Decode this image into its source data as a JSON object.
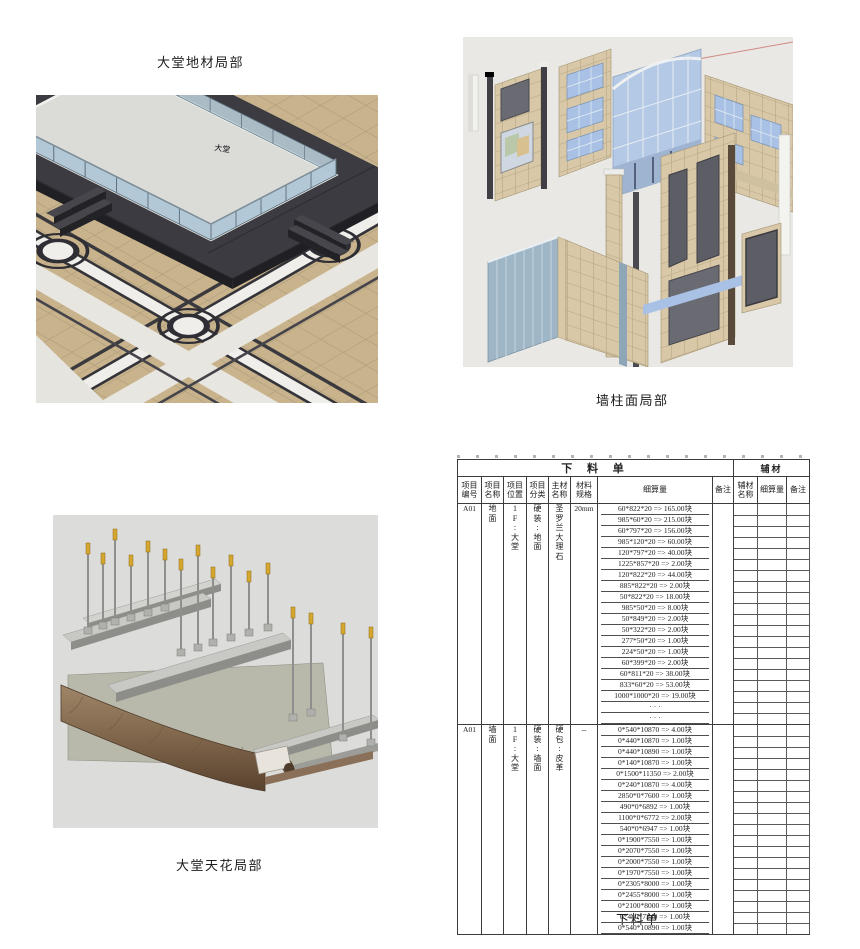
{
  "captions": {
    "floor": "大堂地材局部",
    "wall": "墙柱面局部",
    "ceiling": "大堂天花局部",
    "table": "下料单"
  },
  "figures": {
    "floor": {
      "marker": "大堂"
    }
  },
  "palette": {
    "floor_tan": "#c9b38c",
    "wall_tile_tan": "#d8c8a8",
    "glass_blue": "#b0c7d6",
    "window_blue": "#a8c1e4",
    "dark_tile": "#3b3b41",
    "panel_gray": "#5d5d65",
    "wood_brown": "#8a7058",
    "rod_tip_yellow": "#d6a72e",
    "table_line": "#3c3c3c"
  },
  "table": {
    "title": "下 料 单",
    "aux_header": "辅材",
    "columns": [
      "项目\n编号",
      "项目\n名称",
      "项目\n位置",
      "项目\n分类",
      "主材\n名称",
      "材料\n规格",
      "细算量",
      "备注",
      "辅材\n名称",
      "细算量",
      "备注"
    ],
    "sections": [
      {
        "code": "A01",
        "name": "地面",
        "location": "1F:大堂",
        "category": "硬装:地面",
        "material": "圣罗兰大理石",
        "spec": "20mm",
        "rows": [
          "60*822*20 => 165.00块",
          "985*60*20 => 215.00块",
          "60*797*20 => 156.00块",
          "985*120*20 => 60.00块",
          "120*797*20 => 40.00块",
          "1225*857*20 => 2.00块",
          "120*822*20 => 44.00块",
          "885*822*20 => 2.00块",
          "50*822*20 => 18.00块",
          "985*50*20 => 8.00块",
          "50*849*20 => 2.00块",
          "50*322*20 => 2.00块",
          "277*50*20 => 1.00块",
          "224*50*20 => 1.00块",
          "60*399*20 => 2.00块",
          "60*811*20 => 38.00块",
          "833*60*20 => 53.00块",
          "1000*1000*20 => 19.00块",
          "· · ·",
          "· · ·"
        ]
      },
      {
        "code": "A01",
        "name": "墙面",
        "location": "1F:大堂",
        "category": "硬装:墙面",
        "material": "硬包:皮革",
        "spec": "--",
        "rows": [
          "0*540*10870 => 4.00块",
          "0*440*10870 => 1.00块",
          "0*440*10890 => 1.00块",
          "0*140*10870 => 1.00块",
          "0*1500*11350 => 2.00块",
          "0*240*10870 => 4.00块",
          "2850*0*7600 => 1.00块",
          "490*0*6892 => 1.00块",
          "1100*0*6772 => 2.00块",
          "540*0*6947 => 1.00块",
          "0*1900*7550 => 1.00块",
          "0*2070*7550 => 1.00块",
          "0*2000*7550 => 1.00块",
          "0*1970*7550 => 1.00块",
          "0*2305*8000 => 1.00块",
          "0*2455*8000 => 1.00块",
          "0*2100*8000 => 1.00块",
          "0*440*7340 => 1.00块",
          "0*540*10890 => 1.00块"
        ]
      }
    ]
  }
}
